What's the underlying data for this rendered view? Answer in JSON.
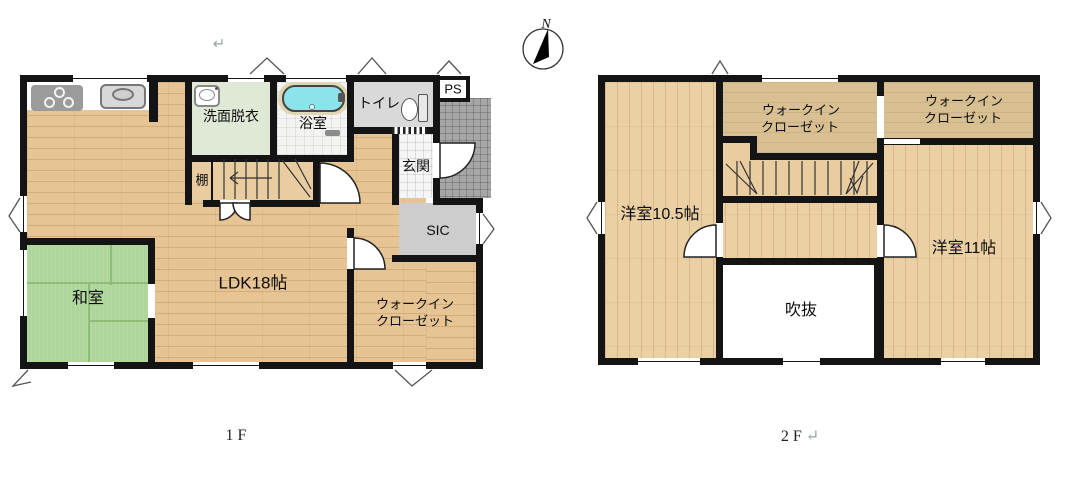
{
  "page": {
    "top_paragraph_mark": "↵"
  },
  "compass": {
    "label": "N"
  },
  "colors": {
    "wall": "#141414",
    "wood": "#e6c493",
    "wood2": "#ebd0a3",
    "wicdark": "#d8c093",
    "tatami": "#aed69b",
    "tatamiline": "#8fbc7a",
    "senmen": "#e0e9d6",
    "tub": "#8ce4ea",
    "toiletfloor": "#d9d9d9",
    "genkan": "#f5f5f5",
    "porch": "#a6a6a6",
    "sic": "#cdcdcd",
    "stairs": "#e9cda1",
    "markgray": "#9aa0a6"
  },
  "floor1": {
    "caption": "1F",
    "labels": {
      "ldk": "LDK18帖",
      "washitsu": "和室",
      "senmen": "洗面脱衣",
      "bath": "浴室",
      "toilet": "トイレ",
      "ps": "PS",
      "genkan": "玄関",
      "sic": "SIC",
      "tana": "棚",
      "wic_line1": "ウォークイン",
      "wic_line2": "クローゼット"
    }
  },
  "floor2": {
    "caption": "2F",
    "caption_mark": "↵",
    "labels": {
      "room105": "洋室10.5帖",
      "room11": "洋室11帖",
      "fukinuke": "吹抜",
      "wic_mid_line1": "ウォークイン",
      "wic_mid_line2": "クローゼット",
      "wic_right_line1": "ウォークイン",
      "wic_right_line2": "クローゼット"
    }
  }
}
